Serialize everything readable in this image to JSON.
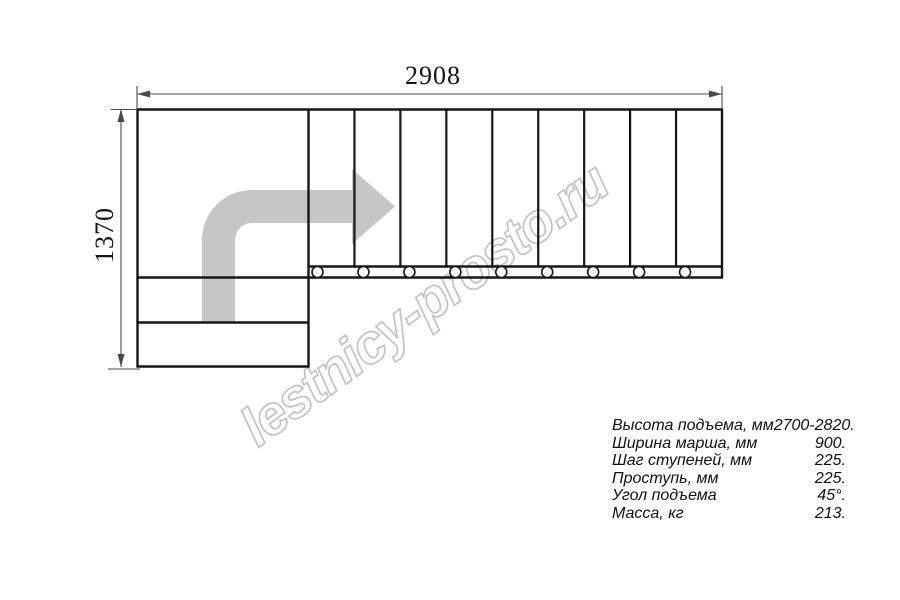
{
  "page": {
    "background": "#ffffff"
  },
  "plan": {
    "line_color": "#161616",
    "dimension_color": "#4a4a4a",
    "arrow_color": "#c6c6c6",
    "top_flight_step_count": 9,
    "lower_flight_step_count": 2,
    "fastener_circle_count": 9
  },
  "dimensions": {
    "width_label": "2908",
    "height_label": "1370"
  },
  "watermark": {
    "text": "lestnicy-prosto.ru",
    "color": "#c3c3c3"
  },
  "specs": {
    "rows": [
      {
        "label": "Высота подъема, мм",
        "value": "2700-2820."
      },
      {
        "label": "Ширина марша, мм",
        "value": "900."
      },
      {
        "label": "Шаг ступеней, мм",
        "value": "225."
      },
      {
        "label": "Проступь, мм",
        "value": "225."
      },
      {
        "label": "Угол подъема",
        "value": "45°."
      },
      {
        "label": "Масса, кг",
        "value": "213."
      }
    ]
  }
}
